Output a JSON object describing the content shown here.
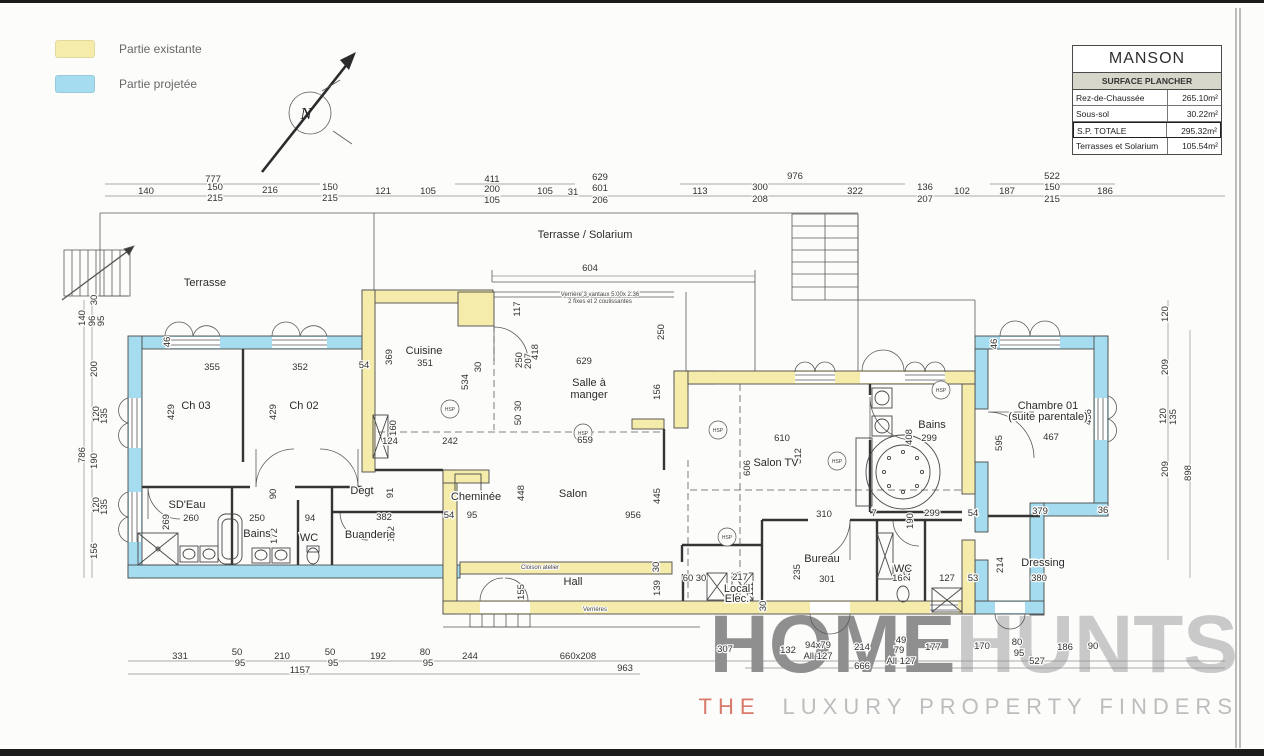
{
  "colors": {
    "existing": "#F5ECAC",
    "projected": "#A6DCEF",
    "wall_stroke": "#4a4a4a",
    "watermark_dark": "#8f8f8f",
    "watermark_light": "#c9c9c9",
    "accent_red": "#d97b6c",
    "titleblock_subtitle_bg": "#d6d6cb"
  },
  "legend": {
    "items": [
      {
        "label": "Partie existante",
        "color": "#F5ECAC"
      },
      {
        "label": "Partie projetée",
        "color": "#A6DCEF"
      }
    ]
  },
  "north_label": "N",
  "title_block": {
    "title": "MANSON",
    "subtitle": "SURFACE PLANCHER",
    "rows": [
      {
        "label": "Rez-de-Chaussée",
        "value": "265.10m²",
        "bold": false
      },
      {
        "label": "Sous-sol",
        "value": "30.22m²",
        "bold": false
      },
      {
        "label": "S.P. TOTALE",
        "value": "295.32m²",
        "bold": true
      },
      {
        "label": "Terrasses et Solarium",
        "value": "105.54m²",
        "bold": false
      }
    ]
  },
  "watermark": {
    "word1": "HOME",
    "word2": "HUNTS",
    "tagline_the": "THE",
    "tagline_rest": "LUXURY PROPERTY FINDERS"
  },
  "plan": {
    "hsp_label": "HSP",
    "hsp": [
      {
        "x": 450,
        "y": 409
      },
      {
        "x": 583,
        "y": 433
      },
      {
        "x": 718,
        "y": 430
      },
      {
        "x": 837,
        "y": 461
      },
      {
        "x": 727,
        "y": 537
      },
      {
        "x": 941,
        "y": 390
      }
    ],
    "area_labels": [
      {
        "t": "Terrasse",
        "x": 205,
        "y": 286
      },
      {
        "t": "Terrasse / Solarium",
        "x": 585,
        "y": 238
      },
      {
        "t": "Ch 03",
        "x": 196,
        "y": 409
      },
      {
        "t": "Ch 02",
        "x": 304,
        "y": 409
      },
      {
        "t": "SD'Eau",
        "x": 187,
        "y": 508
      },
      {
        "t": "Bains",
        "x": 257,
        "y": 537
      },
      {
        "t": "WC",
        "x": 309,
        "y": 541
      },
      {
        "t": "Degt",
        "x": 362,
        "y": 494
      },
      {
        "t": "Buanderie",
        "x": 370,
        "y": 538
      },
      {
        "t": "Cuisine",
        "x": 424,
        "y": 354
      },
      {
        "t": "Salle à",
        "x": 589,
        "y": 386
      },
      {
        "t": "manger",
        "x": 589,
        "y": 398
      },
      {
        "t": "Cheminée",
        "x": 476,
        "y": 500
      },
      {
        "t": "Salon",
        "x": 573,
        "y": 497
      },
      {
        "t": "Hall",
        "x": 573,
        "y": 585
      },
      {
        "t": "Salon TV",
        "x": 776,
        "y": 466
      },
      {
        "t": "Bains",
        "x": 932,
        "y": 428
      },
      {
        "t": "Bureau",
        "x": 822,
        "y": 562
      },
      {
        "t": "WC",
        "x": 903,
        "y": 572
      },
      {
        "t": "Local",
        "x": 737,
        "y": 592
      },
      {
        "t": "Elec.",
        "x": 737,
        "y": 602
      },
      {
        "t": "Chambre 01",
        "x": 1048,
        "y": 409
      },
      {
        "t": "(suite parentale)",
        "x": 1048,
        "y": 420
      },
      {
        "t": "Dressing",
        "x": 1043,
        "y": 566
      }
    ],
    "notes": [
      {
        "t": "Verrière 3 vantaux 5.00x 2.36",
        "x": 600,
        "y": 296
      },
      {
        "t": "2 fixes et 2 coulissantes",
        "x": 600,
        "y": 303
      },
      {
        "t": "Cloison atelier",
        "x": 540,
        "y": 569
      },
      {
        "t": "Verrières",
        "x": 595,
        "y": 611
      }
    ],
    "dim_labels": [
      {
        "t": "777",
        "x": 213,
        "y": 182
      },
      {
        "t": "140",
        "x": 146,
        "y": 194
      },
      {
        "t": "150",
        "x": 215,
        "y": 190
      },
      {
        "t": "215",
        "x": 215,
        "y": 201
      },
      {
        "t": "216",
        "x": 270,
        "y": 193
      },
      {
        "t": "150",
        "x": 330,
        "y": 190
      },
      {
        "t": "215",
        "x": 330,
        "y": 201
      },
      {
        "t": "121",
        "x": 383,
        "y": 194
      },
      {
        "t": "105",
        "x": 428,
        "y": 194
      },
      {
        "t": "411",
        "x": 492,
        "y": 182
      },
      {
        "t": "200",
        "x": 492,
        "y": 192
      },
      {
        "t": "105",
        "x": 492,
        "y": 203
      },
      {
        "t": "105",
        "x": 545,
        "y": 194
      },
      {
        "t": "31",
        "x": 573,
        "y": 195
      },
      {
        "t": "629",
        "x": 600,
        "y": 180
      },
      {
        "t": "601",
        "x": 600,
        "y": 191
      },
      {
        "t": "206",
        "x": 600,
        "y": 203
      },
      {
        "t": "113",
        "x": 700,
        "y": 194
      },
      {
        "t": "300",
        "x": 760,
        "y": 190
      },
      {
        "t": "208",
        "x": 760,
        "y": 202
      },
      {
        "t": "976",
        "x": 795,
        "y": 179
      },
      {
        "t": "322",
        "x": 855,
        "y": 194
      },
      {
        "t": "136",
        "x": 925,
        "y": 190
      },
      {
        "t": "207",
        "x": 925,
        "y": 202
      },
      {
        "t": "102",
        "x": 962,
        "y": 194
      },
      {
        "t": "187",
        "x": 1007,
        "y": 194
      },
      {
        "t": "522",
        "x": 1052,
        "y": 179
      },
      {
        "t": "150",
        "x": 1052,
        "y": 190
      },
      {
        "t": "215",
        "x": 1052,
        "y": 202
      },
      {
        "t": "186",
        "x": 1105,
        "y": 194
      },
      {
        "t": "604",
        "x": 590,
        "y": 271
      },
      {
        "t": "30",
        "x": 97,
        "y": 300,
        "r": -90
      },
      {
        "t": "140",
        "x": 85,
        "y": 318,
        "r": -90
      },
      {
        "t": "96",
        "x": 95,
        "y": 321,
        "r": -90
      },
      {
        "t": "95",
        "x": 104,
        "y": 321,
        "r": -90
      },
      {
        "t": "200",
        "x": 97,
        "y": 369,
        "r": -90
      },
      {
        "t": "120",
        "x": 99,
        "y": 414,
        "r": -90
      },
      {
        "t": "135",
        "x": 107,
        "y": 416,
        "r": -90
      },
      {
        "t": "190",
        "x": 97,
        "y": 461,
        "r": -90
      },
      {
        "t": "120",
        "x": 99,
        "y": 505,
        "r": -90
      },
      {
        "t": "135",
        "x": 107,
        "y": 507,
        "r": -90
      },
      {
        "t": "156",
        "x": 97,
        "y": 551,
        "r": -90
      },
      {
        "t": "786",
        "x": 85,
        "y": 455,
        "r": -90
      },
      {
        "t": "120",
        "x": 1168,
        "y": 314,
        "r": -90
      },
      {
        "t": "209",
        "x": 1168,
        "y": 367,
        "r": -90
      },
      {
        "t": "120",
        "x": 1166,
        "y": 416,
        "r": -90
      },
      {
        "t": "135",
        "x": 1176,
        "y": 417,
        "r": -90
      },
      {
        "t": "209",
        "x": 1168,
        "y": 469,
        "r": -90
      },
      {
        "t": "898",
        "x": 1191,
        "y": 473,
        "r": -90
      },
      {
        "t": "331",
        "x": 180,
        "y": 659
      },
      {
        "t": "50",
        "x": 237,
        "y": 655
      },
      {
        "t": "95",
        "x": 240,
        "y": 666
      },
      {
        "t": "210",
        "x": 282,
        "y": 659
      },
      {
        "t": "50",
        "x": 330,
        "y": 655
      },
      {
        "t": "95",
        "x": 333,
        "y": 666
      },
      {
        "t": "192",
        "x": 378,
        "y": 659
      },
      {
        "t": "80",
        "x": 425,
        "y": 655
      },
      {
        "t": "95",
        "x": 428,
        "y": 666
      },
      {
        "t": "244",
        "x": 470,
        "y": 659
      },
      {
        "t": "1157",
        "x": 300,
        "y": 673
      },
      {
        "t": "660x208",
        "x": 578,
        "y": 659
      },
      {
        "t": "963",
        "x": 625,
        "y": 671
      },
      {
        "t": "307",
        "x": 725,
        "y": 652
      },
      {
        "t": "132",
        "x": 788,
        "y": 653
      },
      {
        "t": "94x79",
        "x": 818,
        "y": 648
      },
      {
        "t": "All 127",
        "x": 818,
        "y": 659
      },
      {
        "t": "214",
        "x": 862,
        "y": 650
      },
      {
        "t": "49",
        "x": 901,
        "y": 643
      },
      {
        "t": "79",
        "x": 899,
        "y": 653
      },
      {
        "t": "All 127",
        "x": 901,
        "y": 664
      },
      {
        "t": "666",
        "x": 862,
        "y": 669
      },
      {
        "t": "177",
        "x": 933,
        "y": 650
      },
      {
        "t": "170",
        "x": 982,
        "y": 649
      },
      {
        "t": "80",
        "x": 1017,
        "y": 645
      },
      {
        "t": "95",
        "x": 1019,
        "y": 656
      },
      {
        "t": "186",
        "x": 1065,
        "y": 650
      },
      {
        "t": "90",
        "x": 1093,
        "y": 649
      },
      {
        "t": "527",
        "x": 1037,
        "y": 664
      },
      {
        "t": "355",
        "x": 212,
        "y": 370
      },
      {
        "t": "352",
        "x": 300,
        "y": 370
      },
      {
        "t": "54",
        "x": 364,
        "y": 368
      },
      {
        "t": "429",
        "x": 174,
        "y": 412,
        "r": -90
      },
      {
        "t": "429",
        "x": 276,
        "y": 412,
        "r": -90
      },
      {
        "t": "46",
        "x": 170,
        "y": 342,
        "r": -90
      },
      {
        "t": "369",
        "x": 392,
        "y": 357,
        "r": -90
      },
      {
        "t": "351",
        "x": 425,
        "y": 366
      },
      {
        "t": "534",
        "x": 468,
        "y": 382,
        "r": -90
      },
      {
        "t": "117",
        "x": 520,
        "y": 309,
        "r": -90
      },
      {
        "t": "250",
        "x": 522,
        "y": 360,
        "r": -90
      },
      {
        "t": "207",
        "x": 531,
        "y": 361,
        "r": -90
      },
      {
        "t": "418",
        "x": 538,
        "y": 352,
        "r": -90
      },
      {
        "t": "629",
        "x": 584,
        "y": 364
      },
      {
        "t": "250",
        "x": 664,
        "y": 332,
        "r": -90
      },
      {
        "t": "156",
        "x": 660,
        "y": 392,
        "r": -90
      },
      {
        "t": "659",
        "x": 585,
        "y": 443
      },
      {
        "t": "242",
        "x": 450,
        "y": 444
      },
      {
        "t": "124",
        "x": 390,
        "y": 444
      },
      {
        "t": "160",
        "x": 396,
        "y": 428,
        "r": -90
      },
      {
        "t": "30",
        "x": 481,
        "y": 367,
        "r": -90
      },
      {
        "t": "30",
        "x": 521,
        "y": 406,
        "r": -90
      },
      {
        "t": "50",
        "x": 521,
        "y": 420,
        "r": -90
      },
      {
        "t": "448",
        "x": 524,
        "y": 493,
        "r": -90
      },
      {
        "t": "445",
        "x": 660,
        "y": 496,
        "r": -90
      },
      {
        "t": "956",
        "x": 633,
        "y": 518
      },
      {
        "t": "606",
        "x": 750,
        "y": 468,
        "r": -90
      },
      {
        "t": "610",
        "x": 782,
        "y": 441
      },
      {
        "t": "512",
        "x": 801,
        "y": 456,
        "r": -90
      },
      {
        "t": "408",
        "x": 912,
        "y": 437,
        "r": -90
      },
      {
        "t": "299",
        "x": 929,
        "y": 441
      },
      {
        "t": "310",
        "x": 824,
        "y": 517
      },
      {
        "t": "7",
        "x": 874,
        "y": 516
      },
      {
        "t": "190",
        "x": 913,
        "y": 521,
        "r": -90
      },
      {
        "t": "299",
        "x": 932,
        "y": 516
      },
      {
        "t": "54",
        "x": 973,
        "y": 516
      },
      {
        "t": "235",
        "x": 800,
        "y": 572,
        "r": -90
      },
      {
        "t": "301",
        "x": 827,
        "y": 582
      },
      {
        "t": "166",
        "x": 900,
        "y": 581
      },
      {
        "t": "232",
        "x": 910,
        "y": 573,
        "r": -90
      },
      {
        "t": "127",
        "x": 947,
        "y": 581
      },
      {
        "t": "53",
        "x": 973,
        "y": 581
      },
      {
        "t": "60",
        "x": 688,
        "y": 581
      },
      {
        "t": "30",
        "x": 701,
        "y": 581
      },
      {
        "t": "217",
        "x": 740,
        "y": 580
      },
      {
        "t": "111",
        "x": 753,
        "y": 589,
        "r": -90
      },
      {
        "t": "30",
        "x": 766,
        "y": 606,
        "r": -90
      },
      {
        "t": "155",
        "x": 524,
        "y": 592,
        "r": -90
      },
      {
        "t": "139",
        "x": 660,
        "y": 588,
        "r": -90
      },
      {
        "t": "30",
        "x": 659,
        "y": 567,
        "r": -90
      },
      {
        "t": "260",
        "x": 191,
        "y": 521
      },
      {
        "t": "269",
        "x": 169,
        "y": 522,
        "r": -90
      },
      {
        "t": "250",
        "x": 257,
        "y": 521
      },
      {
        "t": "94",
        "x": 310,
        "y": 521
      },
      {
        "t": "382",
        "x": 384,
        "y": 520
      },
      {
        "t": "172",
        "x": 277,
        "y": 536,
        "r": -90
      },
      {
        "t": "172",
        "x": 394,
        "y": 534,
        "r": -90
      },
      {
        "t": "90",
        "x": 276,
        "y": 494,
        "r": -90
      },
      {
        "t": "91",
        "x": 393,
        "y": 493,
        "r": -90
      },
      {
        "t": "54",
        "x": 449,
        "y": 518
      },
      {
        "t": "95",
        "x": 472,
        "y": 518
      },
      {
        "t": "46",
        "x": 997,
        "y": 344,
        "r": -90
      },
      {
        "t": "456",
        "x": 1091,
        "y": 417,
        "r": -90
      },
      {
        "t": "595",
        "x": 1002,
        "y": 443,
        "r": -90
      },
      {
        "t": "467",
        "x": 1051,
        "y": 440
      },
      {
        "t": "379",
        "x": 1040,
        "y": 514
      },
      {
        "t": "36",
        "x": 1103,
        "y": 513
      },
      {
        "t": "214",
        "x": 1003,
        "y": 565,
        "r": -90
      },
      {
        "t": "380",
        "x": 1039,
        "y": 581
      }
    ]
  }
}
